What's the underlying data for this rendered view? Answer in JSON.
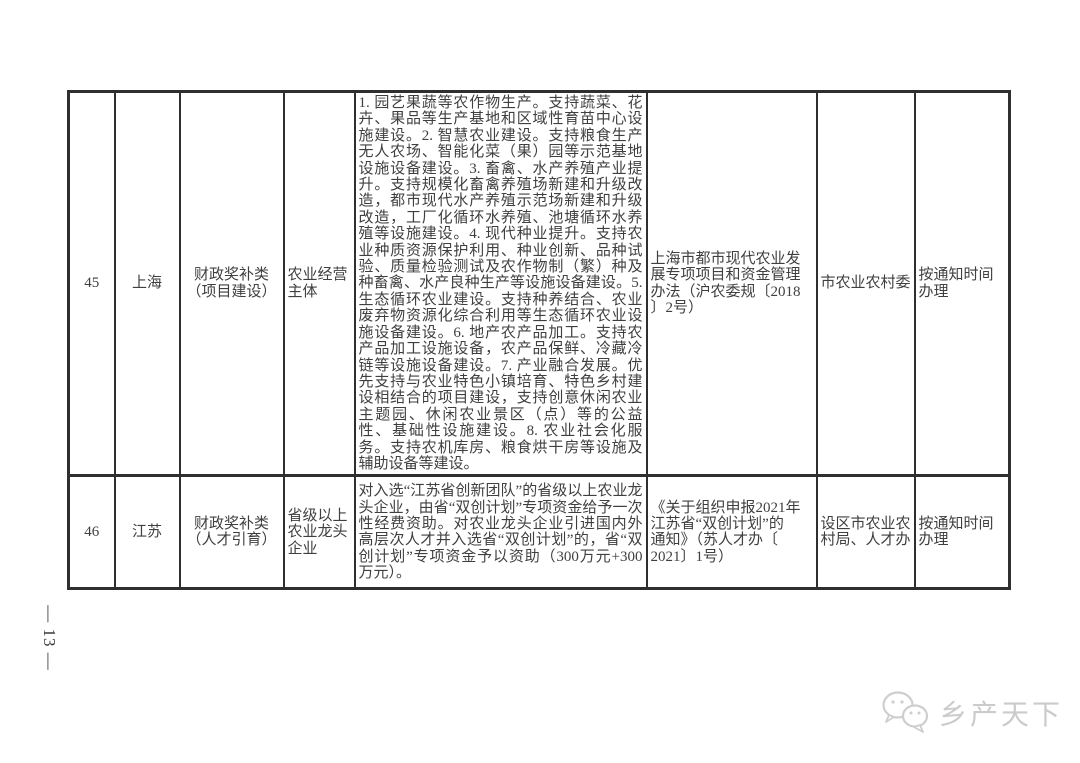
{
  "page": {
    "number_label": "— 13 —",
    "background_color": "#ffffff",
    "table_border_color": "#2f2f2f",
    "text_color": "#3f3f3f"
  },
  "table": {
    "rows": [
      {
        "no": "45",
        "region": "上海",
        "category": "财政奖补类\n（项目建设）",
        "subject": "农业经营\n主体",
        "content": "1. 园艺果蔬等农作物生产。支持蔬菜、花卉、果品等生产基地和区域性育苗中心设施建设。2. 智慧农业建设。支持粮食生产无人农场、智能化菜（果）园等示范基地设施设备建设。3. 畜禽、水产养殖产业提升。支持规模化畜禽养殖场新建和升级改造，都市现代水产养殖示范场新建和升级改造，工厂化循环水养殖、池塘循环水养殖等设施建设。4. 现代种业提升。支持农业种质资源保护利用、种业创新、品种试验、质量检验测试及农作物制（繁）种及种畜禽、水产良种生产等设施设备建设。5. 生态循环农业建设。支持种养结合、农业废弃物资源化综合利用等生态循环农业设施设备建设。6. 地产农产品加工。支持农产品加工设施设备，农产品保鲜、冷藏冷链等设施设备建设。7. 产业融合发展。优先支持与农业特色小镇培育、特色乡村建设相结合的项目建设，支持创意休闲农业主题园、休闲农业景区（点）等的公益性、基础性设施建设。8. 农业社会化服务。支持农机库房、粮食烘干房等设施及辅助设备等建设。",
        "policy_basis": "上海市都市现代农业发\n展专项项目和资金管理\n办法（沪农委规〔2018\n〕2号）",
        "department": "市农业农村委",
        "handle_time": "按通知时间\n办理"
      },
      {
        "no": "46",
        "region": "江苏",
        "category": "财政奖补类\n（人才引育）",
        "subject": "省级以上\n农业龙头\n企业",
        "content": "对入选“江苏省创新团队”的省级以上农业龙头企业，由省“双创计划”专项资金给予一次性经费资助。对农业龙头企业引进国内外高层次人才并入选省“双创计划”的，省“双创计划”专项资金予以资助（300万元+300万元）。",
        "policy_basis": "《关于组织申报2021年\n江苏省“双创计划”的\n通知》（苏人才办〔\n2021〕1号）",
        "department": "设区市农业农\n村局、人才办",
        "handle_time": "按通知时间\n办理"
      }
    ]
  },
  "watermark": {
    "label": "乡产天下",
    "icon": "chat-bubbles",
    "color": "#c9c9c9"
  }
}
